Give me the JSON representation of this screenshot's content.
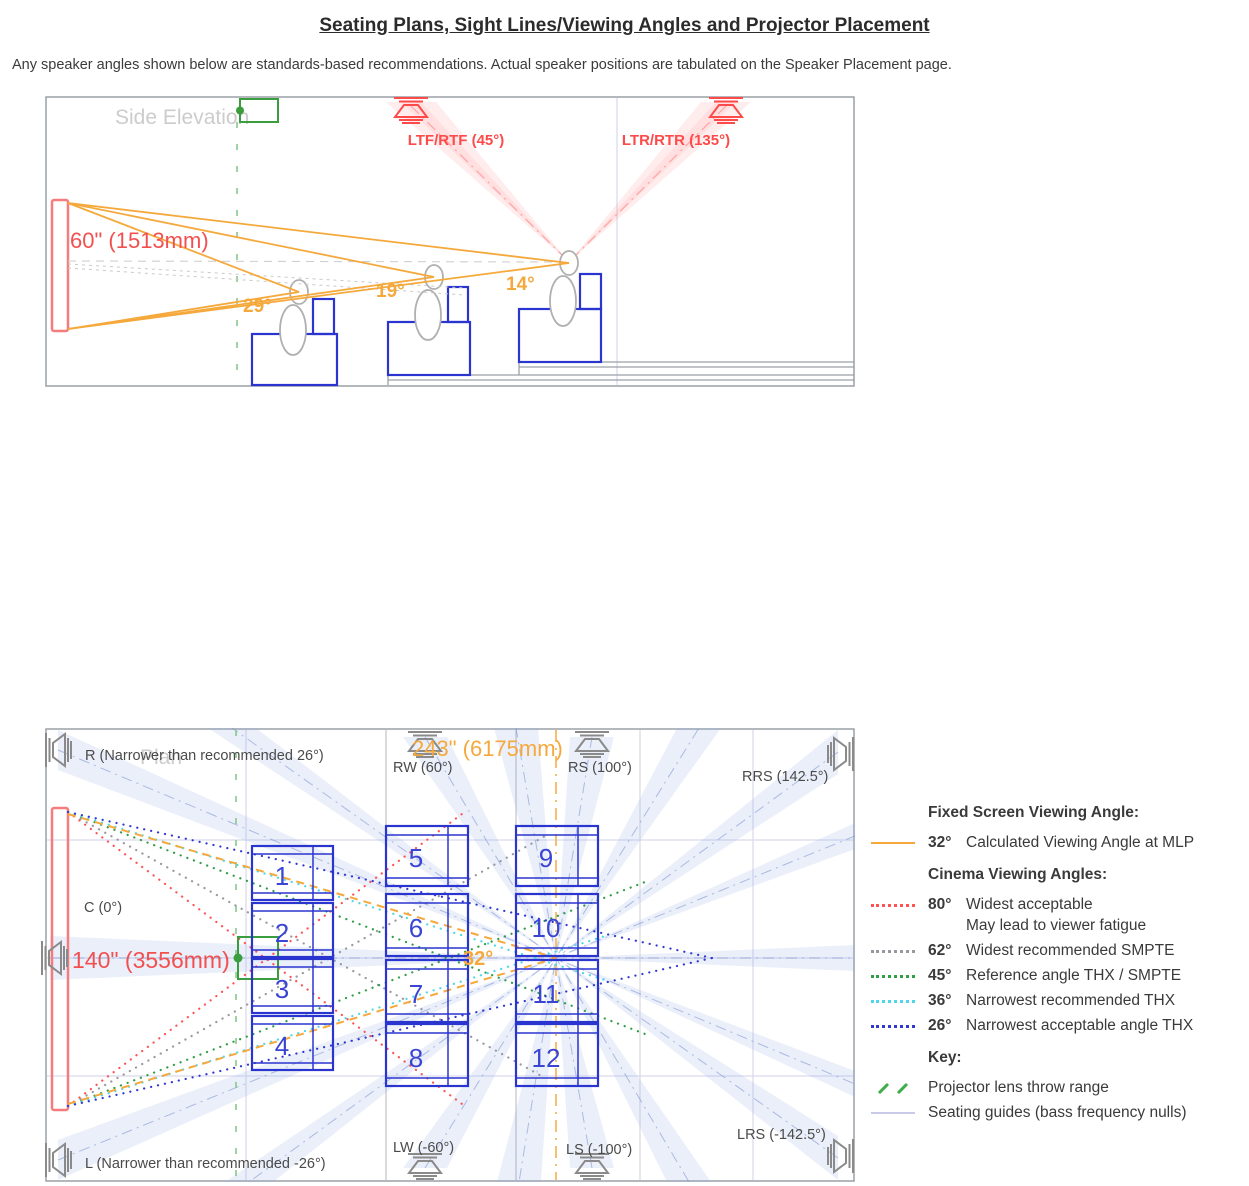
{
  "title": "Seating Plans, Sight Lines/Viewing Angles and Projector Placement",
  "subtitle": "Any speaker angles shown below are standards-based recommendations. Actual speaker positions are tabulated on the Speaker Placement page.",
  "colors": {
    "orange": "#f5a93c",
    "screenRed": "#f47c7c",
    "labelRed": "#f25050",
    "speakerRed": "#ff4a4a",
    "seatBlue": "#2a35cf",
    "numBlue": "#3a45d4",
    "dotRed": "#ff5252",
    "dotGray": "#98989f",
    "dotGreen": "#2f9e44",
    "dotCyan": "#4dd7e8",
    "dotBlue": "#3038d0",
    "green": "#3a9e3f",
    "gray": "#8a8a8a",
    "textGray": "#4a4a4a"
  },
  "icons": {
    "speaker": "horn-speaker-icon",
    "projector": "projector-icon"
  },
  "side": {
    "watermark": "Side Elevation",
    "screen_size": "60\" (1513mm)",
    "speakers": [
      {
        "label": "LTF/RTF (45°)"
      },
      {
        "label": "LTR/RTR (135°)"
      }
    ],
    "angles": [
      "29°",
      "19°",
      "14°"
    ]
  },
  "plan": {
    "watermark": "Plan",
    "screen_size": "140\" (3556mm)",
    "throw_distance": "243\" (6175mm)",
    "mlp_angle": "32°",
    "speakers": {
      "r": "R (Narrower than recommended 26°)",
      "c": "C (0°)",
      "l": "L (Narrower than recommended -26°)",
      "rw": "RW (60°)",
      "rs": "RS (100°)",
      "rrs": "RRS (142.5°)",
      "lw": "LW (-60°)",
      "ls": "LS (-100°)",
      "lrs": "LRS (-142.5°)"
    },
    "seats": [
      "1",
      "2",
      "3",
      "4",
      "5",
      "6",
      "7",
      "8",
      "9",
      "10",
      "11",
      "12"
    ]
  },
  "legend": {
    "fixed_heading": "Fixed Screen Viewing Angle:",
    "fixed": {
      "angle": "32°",
      "desc": "Calculated Viewing Angle at MLP"
    },
    "cinema_heading": "Cinema Viewing Angles:",
    "cinema": [
      {
        "angle": "80°",
        "desc": "Widest acceptable",
        "desc2": "May lead to viewer fatigue"
      },
      {
        "angle": "62°",
        "desc": "Widest recommended SMPTE"
      },
      {
        "angle": "45°",
        "desc": "Reference angle THX / SMPTE"
      },
      {
        "angle": "36°",
        "desc": "Narrowest recommended THX"
      },
      {
        "angle": "26°",
        "desc": "Narrowest acceptable angle THX"
      }
    ],
    "key_heading": "Key:",
    "key": [
      {
        "label": "Projector lens throw range"
      },
      {
        "label": "Seating guides (bass frequency nulls)"
      }
    ]
  }
}
